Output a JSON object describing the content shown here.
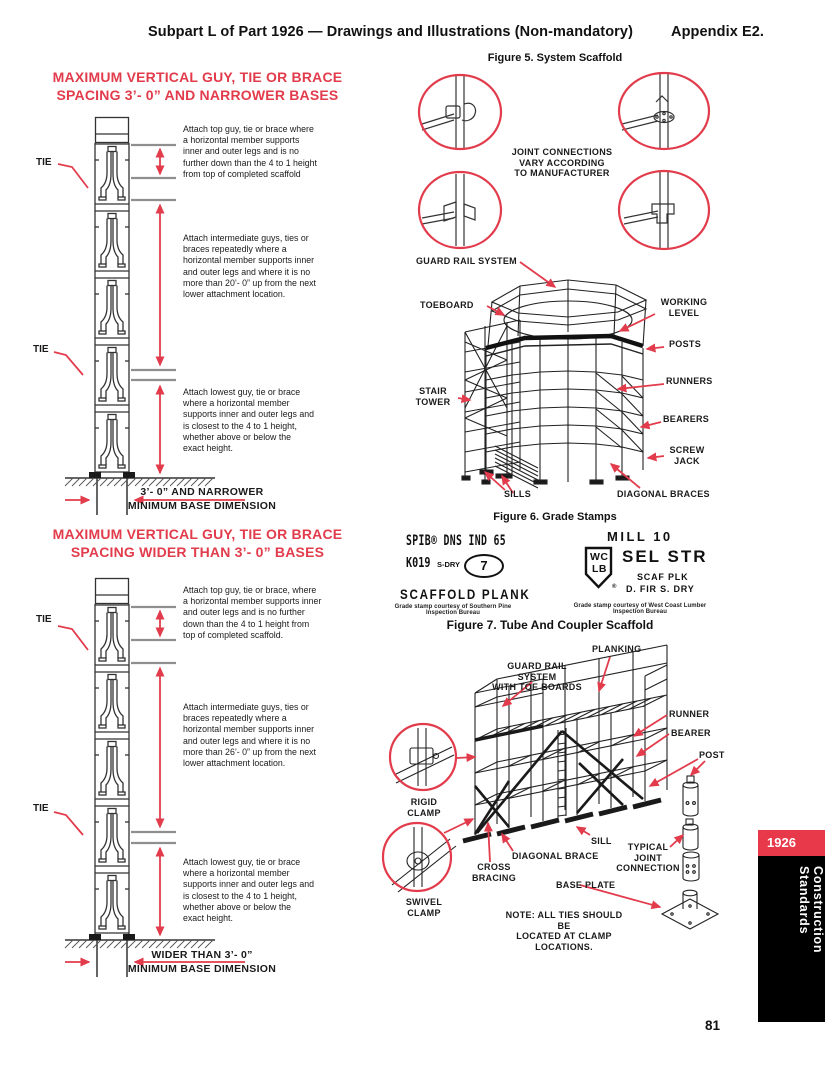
{
  "colors": {
    "red": "#e23c4c",
    "ink": "#1a1a1a",
    "sidebar_red": "#e8394a",
    "sidebar_black": "#000000"
  },
  "header": {
    "title": "Subpart L of Part 1926 — Drawings and Illustrations (Non-mandatory)",
    "appendix": "Appendix E2."
  },
  "page_number": "81",
  "sidebar": {
    "year": "1926",
    "label": "Construction Standards"
  },
  "diagram_narrow": {
    "title": "MAXIMUM VERTICAL GUY, TIE OR BRACE\nSPACING 3’- 0” AND NARROWER BASES",
    "tie": "TIE",
    "note_top": "Attach top guy, tie or brace where\na horizontal member supports\ninner and outer legs and is no\nfurther down than the 4 to 1 height\nfrom top of completed scaffold",
    "note_mid": "Attach intermediate guys, ties or\nbraces repeatedly where a\nhorizontal member supports inner\nand outer legs and where it is no\nmore than 20’- 0” up from the next\nlower attachment location.",
    "note_bottom": "Attach lowest guy, tie or brace\nwhere a horizontal member\nsupports inner and outer legs and\nis closest to the 4 to 1 height,\nwhether above or below the\nexact height.",
    "base_line1": "3’- 0” AND NARROWER",
    "base_line2": "MINIMUM BASE DIMENSION"
  },
  "diagram_wide": {
    "title": "MAXIMUM VERTICAL GUY, TIE OR BRACE\nSPACING WIDER THAN 3’- 0” BASES",
    "tie": "TIE",
    "note_top": "Attach top guy, tie or brace, where\na horizontal member supports inner\nand outer legs and is no further\ndown than the 4 to 1 height from\ntop of completed scaffold.",
    "note_mid": "Attach intermediate guys, ties or\nbraces repeatedly where a\nhorizontal member supports inner\nand outer legs and where it is no\nmore than 26’- 0” up from the next\nlower attachment location.",
    "note_bottom": "Attach lowest guy, tie or brace\nwhere a horizontal member\nsupports inner and outer legs and\nis closest to the 4 to 1 height,\nwhether above or below the\nexact height.",
    "base_line1": "WIDER THAN 3’- 0”",
    "base_line2": "MINIMUM BASE DIMENSION"
  },
  "figure5": {
    "caption": "Figure 5. System Scaffold",
    "joint_note": "JOINT CONNECTIONS\nVARY ACCORDING\nTO MANUFACTURER",
    "labels": {
      "guard_rail": "GUARD RAIL SYSTEM",
      "toeboard": "TOEBOARD",
      "working_level": "WORKING\nLEVEL",
      "posts": "POSTS",
      "runners": "RUNNERS",
      "bearers": "BEARERS",
      "screw_jack": "SCREW\nJACK",
      "stair_tower": "STAIR\nTOWER",
      "sills": "SILLS",
      "diagonal_braces": "DIAGONAL BRACES"
    }
  },
  "figure6": {
    "caption": "Figure 6. Grade Stamps",
    "left": {
      "brand_line": "SPIB® DNS IND 65",
      "code": "K019",
      "dry": "S-DRY",
      "badge": "7",
      "product": "SCAFFOLD  PLANK",
      "credit": "Grade stamp courtesy of Southern Pine Inspection Bureau"
    },
    "right": {
      "mill": "MILL 10",
      "shield_top": "WC",
      "shield_bottom": "LB",
      "reg": "®",
      "grade": "SEL STR",
      "spec1": "SCAF PLK",
      "spec2": "D. FIR    S. DRY",
      "credit": "Grade stamp courtesy of West Coast Lumber Inspection Bureau"
    }
  },
  "figure7": {
    "caption": "Figure 7. Tube And Coupler Scaffold",
    "labels": {
      "planking": "PLANKING",
      "guard_rail": "GUARD RAIL SYSTEM\nWITH TOE BOARDS",
      "runner": "RUNNER",
      "bearer": "BEARER",
      "post": "POST",
      "rigid_clamp": "RIGID\nCLAMP",
      "swivel_clamp": "SWIVEL\nCLAMP",
      "cross_bracing": "CROSS\nBRACING",
      "diagonal_brace": "DIAGONAL BRACE",
      "sill": "SILL",
      "base_plate": "BASE PLATE",
      "typical_joint": "TYPICAL\nJOINT\nCONNECTION"
    },
    "note": "NOTE: ALL TIES SHOULD BE\nLOCATED AT CLAMP LOCATIONS."
  }
}
